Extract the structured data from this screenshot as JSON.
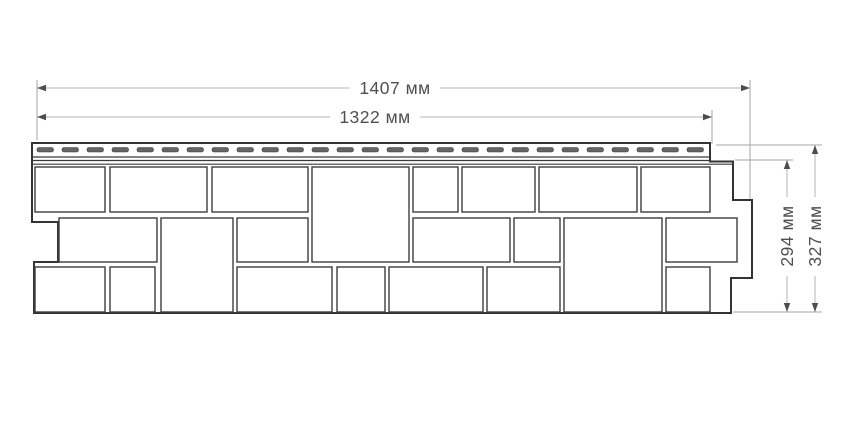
{
  "drawing": {
    "kind": "technical-dimension-diagram",
    "colors": {
      "background": "#ffffff",
      "outline": "#333333",
      "block_line": "#3d3d3d",
      "strip_line": "#3a3a3a",
      "dash_fill": "#646464",
      "dash_stroke": "#3d3d3d",
      "dim_line": "#b3b3b3",
      "ext_line": "#a6a6a6",
      "arrow": "#4d4d4d",
      "text": "#4f4f4f"
    }
  },
  "dimensions": {
    "total_width": {
      "label": "1407 мм",
      "value": 1407,
      "unit": "мм"
    },
    "visible_width": {
      "label": "1322 мм",
      "value": 1322,
      "unit": "мм"
    },
    "visible_height": {
      "label": "294 мм",
      "value": 294,
      "unit": "мм"
    },
    "total_height": {
      "label": "327 мм",
      "value": 327,
      "unit": "мм"
    }
  },
  "geometry": {
    "outline_path": "M32,143 L710,143 L710,161.5 L733,161.5 L733,200 L752,200 L752,278 L731,278 L731,313 L34,313 L34,262 L58,262 L58,222 L32,222 Z",
    "strip": {
      "dash": {
        "x1": 37,
        "x2": 706,
        "step": 25,
        "w": 16.5,
        "h": 4.5,
        "y": 147.5,
        "rx": 2
      },
      "lines": [
        {
          "x1": 32,
          "y": 157,
          "x2": 710
        },
        {
          "x1": 32,
          "y": 160.5,
          "x2": 710
        },
        {
          "x1": 32,
          "y": 164.2,
          "x2": 733
        }
      ]
    },
    "blocks": [
      [
        35,
        167,
        70,
        45
      ],
      [
        110,
        167,
        97,
        45
      ],
      [
        212,
        167,
        96,
        45
      ],
      [
        312,
        167,
        97,
        95
      ],
      [
        413,
        167,
        45,
        45
      ],
      [
        462,
        167,
        73,
        45
      ],
      [
        539,
        167,
        98,
        45
      ],
      [
        641,
        167,
        69,
        45
      ],
      [
        59,
        218,
        98,
        44
      ],
      [
        161,
        218,
        72,
        94
      ],
      [
        237,
        218,
        71,
        44
      ],
      [
        413,
        218,
        97,
        44
      ],
      [
        514,
        218,
        46,
        44
      ],
      [
        564,
        218,
        98,
        94
      ],
      [
        666,
        218,
        71,
        44
      ],
      [
        35,
        267,
        70,
        45
      ],
      [
        110,
        267,
        45,
        45
      ],
      [
        237,
        267,
        95,
        45
      ],
      [
        337,
        267,
        48,
        45
      ],
      [
        389,
        267,
        94,
        45
      ],
      [
        487,
        267,
        73,
        45
      ],
      [
        666,
        267,
        44,
        45
      ]
    ],
    "dim_lines": [
      {
        "id": "total-width",
        "type": "h",
        "y": 88,
        "x1": 37,
        "x2": 750,
        "break": [
          350,
          440
        ]
      },
      {
        "id": "visible-width",
        "type": "h",
        "y": 117,
        "x1": 37,
        "x2": 712,
        "break": [
          330,
          420
        ]
      },
      {
        "id": "visible-height",
        "type": "v",
        "x": 787,
        "y1": 160,
        "y2": 312,
        "break": [
          197,
          276
        ]
      },
      {
        "id": "total-height",
        "type": "v",
        "x": 815,
        "y1": 145,
        "y2": 312,
        "break": [
          197,
          276
        ]
      }
    ],
    "ext_lines": [
      [
        37,
        80,
        37,
        140
      ],
      [
        750,
        80,
        750,
        199
      ],
      [
        712,
        110,
        712,
        144
      ],
      [
        716,
        145,
        822,
        145
      ],
      [
        735,
        160,
        793,
        160
      ],
      [
        733,
        312,
        822,
        312
      ]
    ],
    "labels": [
      {
        "bind": "dimensions.total_width.label",
        "x": 395,
        "y": 94,
        "rotate": null,
        "name": "dim-label-total-width"
      },
      {
        "bind": "dimensions.visible_width.label",
        "x": 375,
        "y": 123,
        "rotate": null,
        "name": "dim-label-visible-width"
      },
      {
        "bind": "dimensions.visible_height.label",
        "x": 787,
        "y": 242,
        "rotate": [
          -90,
          787,
          236
        ],
        "name": "dim-label-visible-height"
      },
      {
        "bind": "dimensions.total_height.label",
        "x": 815,
        "y": 242,
        "rotate": [
          -90,
          815,
          236
        ],
        "name": "dim-label-total-height"
      }
    ]
  }
}
